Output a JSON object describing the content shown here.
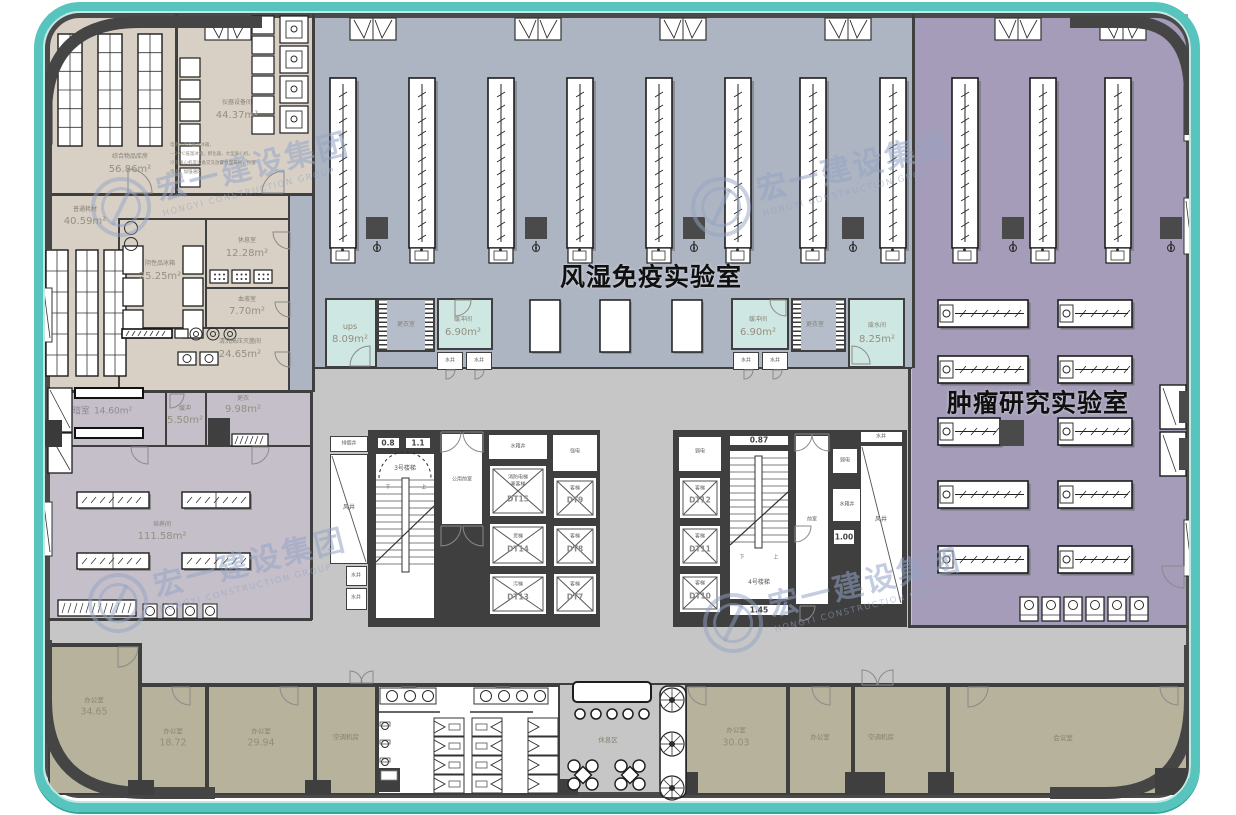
{
  "titles": {
    "center_lab": "风湿免疫实验室",
    "right_lab": "肿瘤研究实验室"
  },
  "watermark": {
    "cn": "宏一建设集团",
    "en": "HONGYI CONSTRUCTION GROUP"
  },
  "rooms": {
    "storage": {
      "name": "综合物品库房",
      "area": "56.86m²"
    },
    "instrument": {
      "name": "仪器设备间",
      "area": "44.37m²",
      "note1": "电源—4℃低温冰箱，",
      "note2": "—20℃低温冰箱，孵化器，大型离心机，",
      "note3": "冷冻离心机等设备交叉放置合理布局，预留",
      "note4": "电源，加强通风"
    },
    "consumable": {
      "name": "普通耗材",
      "area": "40.59m²"
    },
    "negative": {
      "name": "阴性品冰箱",
      "area": "25.25m²"
    },
    "rest_small": {
      "name": "休息室",
      "area": "12.28m²"
    },
    "blood": {
      "name": "血液室",
      "area": "7.70m²"
    },
    "sterilize": {
      "name": "清洗高压灭菌间",
      "area": "24.65m²"
    },
    "dark": {
      "name": "暗室",
      "area": "14.60m²"
    },
    "buffer_small": {
      "name": "缓冲",
      "area": "5.50m²"
    },
    "changing_small": {
      "name": "更衣",
      "area": "9.98m²"
    },
    "culture": {
      "name": "培养间",
      "area": "111.58m²"
    },
    "ups": {
      "name": "ups",
      "area": "8.09m²"
    },
    "changing_left": {
      "name": "更衣室"
    },
    "buffer_left": {
      "name": "缓冲间",
      "area": "6.90m²"
    },
    "buffer_right": {
      "name": "缓冲间",
      "area": "6.90m²"
    },
    "changing_right": {
      "name": "更衣室"
    },
    "waste_water": {
      "name": "废水间",
      "area": "8.25m²"
    }
  },
  "mint_wells": [
    "水井",
    "水井",
    "水井",
    "水井"
  ],
  "core1": {
    "smoke_shaft": "排烟井",
    "air_shaft": "风井",
    "water_shaft1": "水井",
    "water_shaft2": "水井",
    "dim1": "0.8",
    "dim2": "1.1",
    "stair": "3号楼梯",
    "up": "上",
    "down": "下",
    "lobby": "公用前室",
    "tank": "水箱井",
    "strong_power": "强电",
    "lift_fire_l1": "消防电梯",
    "lift_fire_l2": "兼客梯",
    "lift_fire_id": "DT15",
    "lift9": "客梯",
    "lift9_id": "DT9",
    "lift14": "货梯",
    "lift14_id": "DT14",
    "lift8": "客梯",
    "lift8_id": "DT8",
    "lift13": "污梯",
    "lift13_id": "DT13",
    "lift7": "客梯",
    "lift7_id": "DT7"
  },
  "core2": {
    "weak_power": "弱电",
    "weak_power2": "弱电",
    "lift12": "客梯",
    "lift12_id": "DT12",
    "lift11": "客梯",
    "lift11_id": "DT11",
    "lift10": "客梯",
    "lift10_id": "DT10",
    "dim_top": "0.87",
    "dim_bottom": "1.45",
    "dim_mid": "1.00",
    "stair": "4号楼梯",
    "up": "上",
    "down": "下",
    "lobby": "前室",
    "tank": "水箱井",
    "air_shaft": "风井",
    "water_shaft": "水井"
  },
  "bottom": {
    "office1": {
      "name": "办公室",
      "area": "34.65"
    },
    "office2": {
      "name": "办公室",
      "area": "18.72"
    },
    "office3": {
      "name": "办公室",
      "area": "29.94"
    },
    "ac1": {
      "name": "空调机房"
    },
    "rest_zone": {
      "name": "休息区"
    },
    "office4": {
      "name": "办公室",
      "area": "30.03"
    },
    "office5": {
      "name": "办公室"
    },
    "ac2": {
      "name": "空调机房"
    },
    "meeting": {
      "name": "会议室"
    }
  }
}
